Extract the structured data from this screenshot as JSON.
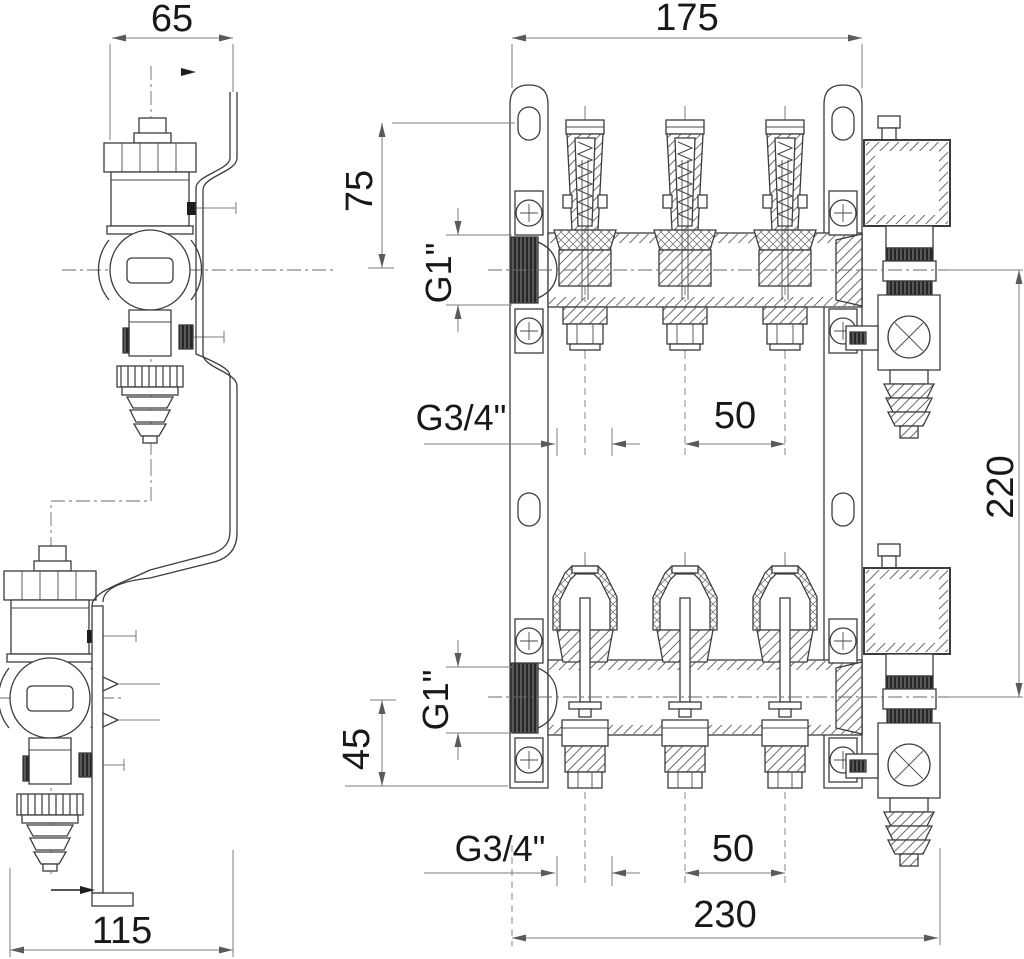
{
  "drawing": {
    "type": "technical-drawing",
    "component": "heating manifold assembly, sectional front views and valve side views",
    "colors": {
      "background": "#ffffff",
      "outline": "#3c3c3c",
      "dimension_lines": "#7d7d7d",
      "text": "#181818"
    },
    "views": {
      "upper_side_view": "valve side view (top left)",
      "upper_front_view": "upper manifold sectional view",
      "lower_side_view": "valve side view (bottom left)",
      "lower_front_view": "lower manifold sectional view"
    },
    "dimensions": {
      "top_width": "65",
      "upper_manifold_width": "175",
      "bracket_hole_to_axis": "75",
      "upper_inlet_thread": "G1\"",
      "upper_outlet_thread": "G3/4\"",
      "upper_outlet_spacing": "50",
      "axis_to_axis_height": "220",
      "lower_inlet_thread": "G1\"",
      "axis_to_outlet": "45",
      "lower_outlet_thread": "G3/4\"",
      "lower_outlet_spacing": "50",
      "bottom_width": "115",
      "lower_manifold_width": "230"
    }
  }
}
